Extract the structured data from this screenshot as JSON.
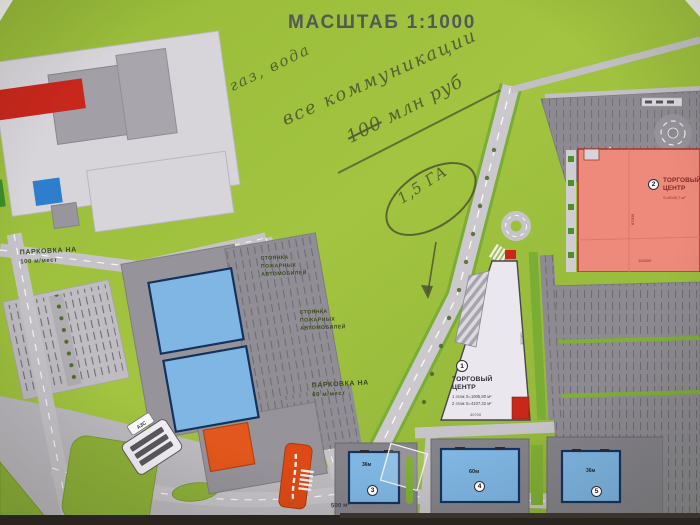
{
  "title": "МАСШТАБ 1:1000",
  "handwriting": {
    "note1": "газ, вода",
    "note2": "все коммуникации",
    "amount": "100",
    "amount_unit": "млн руб",
    "area_note": "1,5 ГА"
  },
  "labels": {
    "parking100": [
      "ПАРКОВКА НА",
      "100 м/мест"
    ],
    "parking60": [
      "ПАРКОВКА НА",
      "60 м/мест"
    ],
    "fire_parking_1": [
      "СТОЯНКА",
      "ПОЖАРНЫХ",
      "АВТОМОБИЛЕЙ"
    ],
    "fire_parking_2": [
      "СТОЯНКА",
      "ПОЖАРНЫХ",
      "АВТОМОБИЛЕЙ"
    ],
    "area_500": "500 м²",
    "azs": "АЗС"
  },
  "buildings": {
    "tc1": {
      "num": "1",
      "name": "ТОРГОВЫЙ ЦЕНТР",
      "floor1": "1 этаж S=1905,80 м²",
      "floor2": "2 этаж S=4107,32 м²",
      "dim_right": "111060",
      "dim_bottom": "40700"
    },
    "tc2": {
      "num": "2",
      "name": "ТОРГОВЫЙ ЦЕНТР",
      "area": "S=8045,7 м²",
      "dim_vert": "87500",
      "dim_horiz": "104000"
    },
    "b3": {
      "num": "3",
      "dim": "36м"
    },
    "b4": {
      "num": "4",
      "dim": "60м"
    },
    "b5": {
      "num": "5",
      "dim": "36м"
    }
  },
  "colors": {
    "background_green": "#9cbf3e",
    "building_blue": "#7fb6e3",
    "mall_pink": "#ee8a7c",
    "accent_red": "#c8271c",
    "accent_orange": "#e2571b",
    "road_gray": "#c7c4c9",
    "parking_gray": "#8d8b91",
    "pencil": "#4c5430"
  }
}
